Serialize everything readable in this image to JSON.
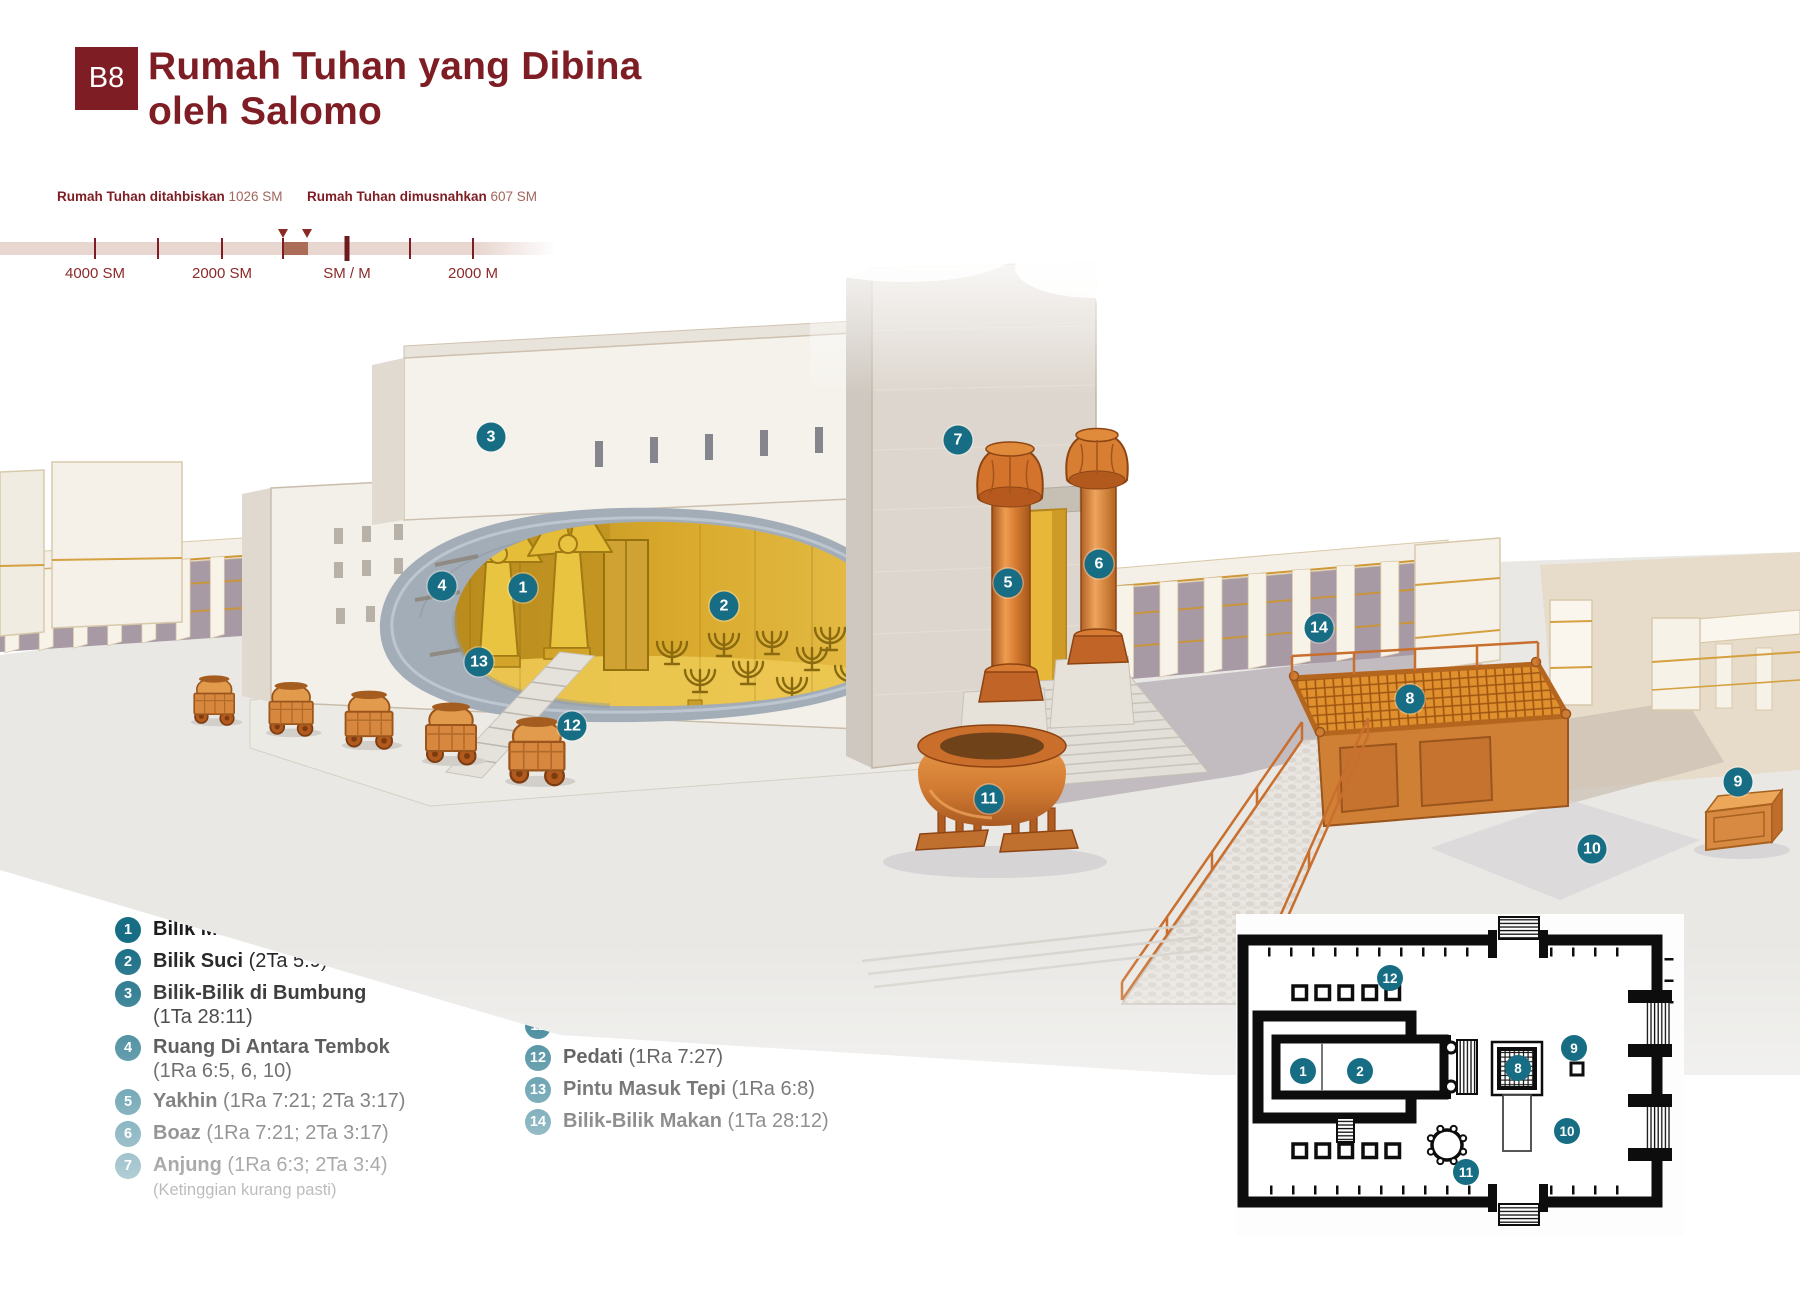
{
  "colors": {
    "accent": "#7f1d24",
    "accent_soft": "#a2655c",
    "marker_teal": "#176d84",
    "bronze": "#d98a42",
    "gold": "#d9b13a"
  },
  "header": {
    "badge": "B8",
    "title_line1": "Rumah Tuhan yang Dibina",
    "title_line2": "oleh Salomo"
  },
  "timeline": {
    "events": [
      {
        "label": "Rumah Tuhan ditahbiskan",
        "year": "1026 SM"
      },
      {
        "label": "Rumah Tuhan dimusnahkan",
        "year": "607 SM"
      }
    ],
    "axis_labels": [
      "4000 SM",
      "2000 SM",
      "SM / M",
      "2000 M"
    ]
  },
  "legend": {
    "heading": "Ciri-Ciri Rumah Tuhan",
    "items": [
      {
        "n": "1",
        "name": "Bilik Maha Suci",
        "ref": "(1Ra 6:16, 20)",
        "wrap": false
      },
      {
        "n": "2",
        "name": "Bilik Suci",
        "ref": "(2Ta 5:9)",
        "wrap": false
      },
      {
        "n": "3",
        "name": "Bilik-Bilik di Bumbung",
        "ref": "(1Ta 28:11)",
        "wrap": true
      },
      {
        "n": "4",
        "name": "Ruang Di Antara Tembok",
        "ref": "(1Ra 6:5, 6, 10)",
        "wrap": true
      },
      {
        "n": "5",
        "name": "Yakhin",
        "ref": "(1Ra 7:21; 2Ta 3:17)",
        "wrap": false
      },
      {
        "n": "6",
        "name": "Boaz",
        "ref": "(1Ra 7:21; 2Ta 3:17)",
        "wrap": false
      },
      {
        "n": "7",
        "name": "Anjung",
        "ref": "(1Ra 6:3; 2Ta 3:4)",
        "wrap": false,
        "note": "(Ketinggian kurang pasti)"
      },
      {
        "n": "8",
        "name": "Mazbah Tembaga",
        "ref": "(2Ta 4:1)",
        "wrap": false
      },
      {
        "n": "9",
        "name": "Pentas Tembaga",
        "ref": "(2Ta 6:13)",
        "wrap": false
      },
      {
        "n": "10",
        "name": "Halaman Dalam",
        "ref": "(1Ra 6:36)",
        "wrap": false
      },
      {
        "n": "11",
        "name": "Laut Tembaga",
        "ref": "(1Ra 7:23)",
        "wrap": false
      },
      {
        "n": "12",
        "name": "Pedati",
        "ref": "(1Ra 7:27)",
        "wrap": false
      },
      {
        "n": "13",
        "name": "Pintu Masuk Tepi",
        "ref": "(1Ra 6:8)",
        "wrap": false
      },
      {
        "n": "14",
        "name": "Bilik-Bilik Makan",
        "ref": "(1Ta 28:12)",
        "wrap": false
      }
    ]
  },
  "scene_markers": [
    {
      "n": "1",
      "x": 523,
      "y": 588
    },
    {
      "n": "2",
      "x": 724,
      "y": 606
    },
    {
      "n": "3",
      "x": 491,
      "y": 437
    },
    {
      "n": "4",
      "x": 442,
      "y": 586
    },
    {
      "n": "5",
      "x": 1008,
      "y": 583
    },
    {
      "n": "6",
      "x": 1099,
      "y": 564
    },
    {
      "n": "7",
      "x": 958,
      "y": 440
    },
    {
      "n": "8",
      "x": 1410,
      "y": 699
    },
    {
      "n": "9",
      "x": 1738,
      "y": 782
    },
    {
      "n": "10",
      "x": 1592,
      "y": 849
    },
    {
      "n": "11",
      "x": 989,
      "y": 799
    },
    {
      "n": "12",
      "x": 572,
      "y": 726
    },
    {
      "n": "13",
      "x": 479,
      "y": 662
    },
    {
      "n": "14",
      "x": 1319,
      "y": 628
    }
  ],
  "plan_markers": [
    {
      "n": "1",
      "x": 67,
      "y": 145
    },
    {
      "n": "2",
      "x": 124,
      "y": 145
    },
    {
      "n": "8",
      "x": 282,
      "y": 142
    },
    {
      "n": "9",
      "x": 338,
      "y": 122
    },
    {
      "n": "10",
      "x": 331,
      "y": 205
    },
    {
      "n": "11",
      "x": 230,
      "y": 246
    },
    {
      "n": "12",
      "x": 154,
      "y": 52
    }
  ]
}
